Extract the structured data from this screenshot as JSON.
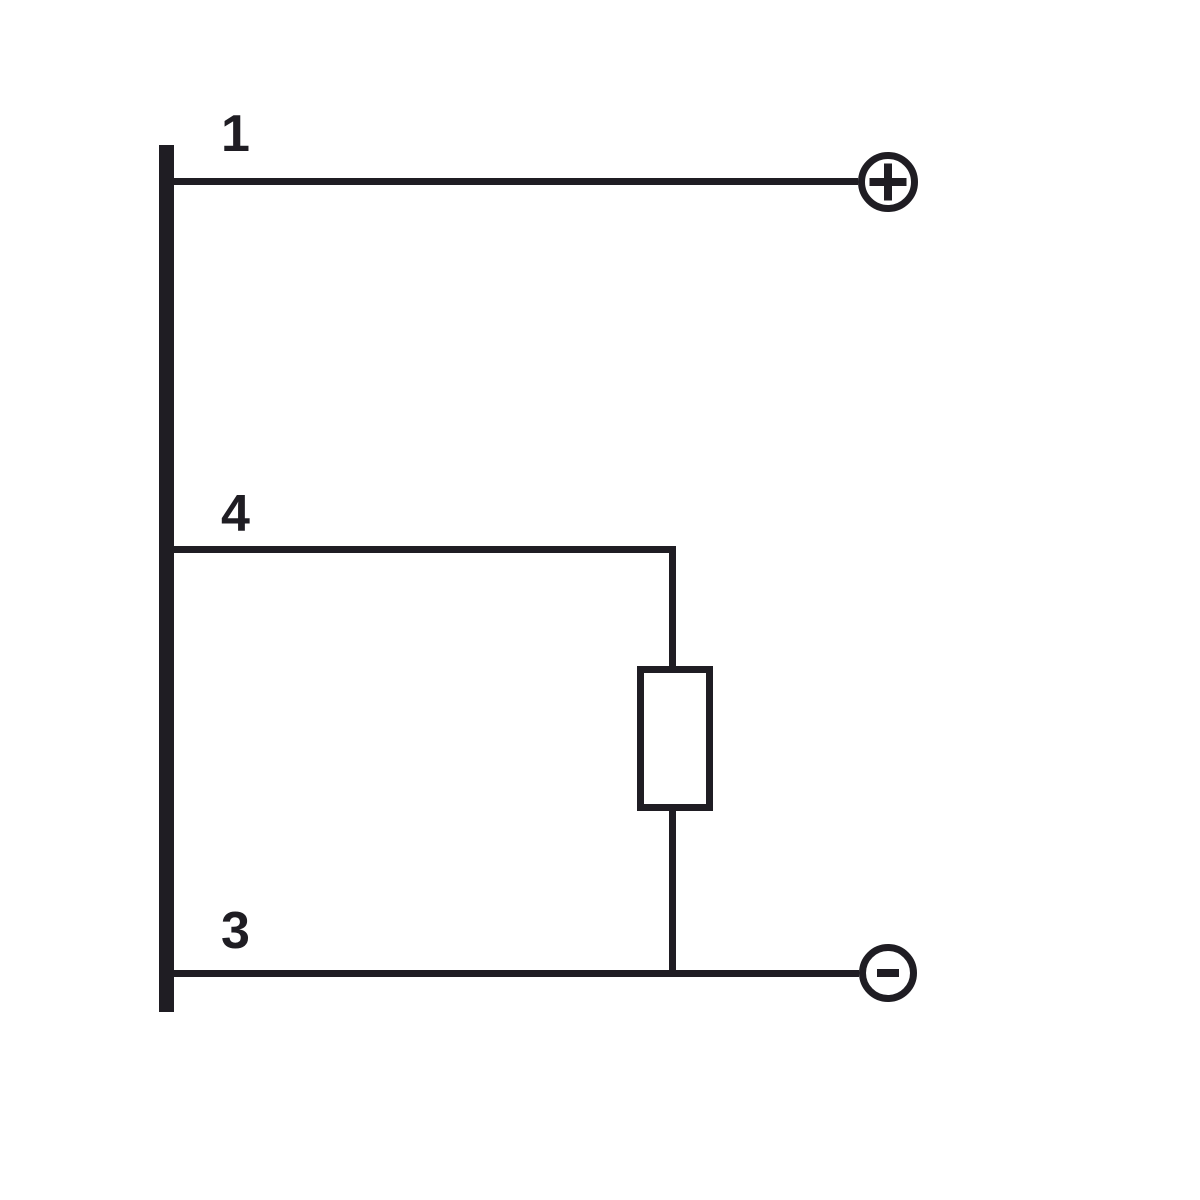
{
  "diagram": {
    "type": "wiring-diagram",
    "colors": {
      "line": "#1f1d23",
      "background": "#ffffff"
    },
    "busbar": {
      "description": "vertical bus bar on left edge connecting all wires"
    },
    "wires": [
      {
        "label": "1",
        "terminal_symbol": "+",
        "terminal": "positive"
      },
      {
        "label": "4",
        "connects_to": "resistor"
      },
      {
        "label": "3",
        "terminal_symbol": "-",
        "terminal": "negative"
      }
    ],
    "components": [
      {
        "type": "resistor",
        "between_wires": [
          "4",
          "3"
        ]
      }
    ]
  }
}
